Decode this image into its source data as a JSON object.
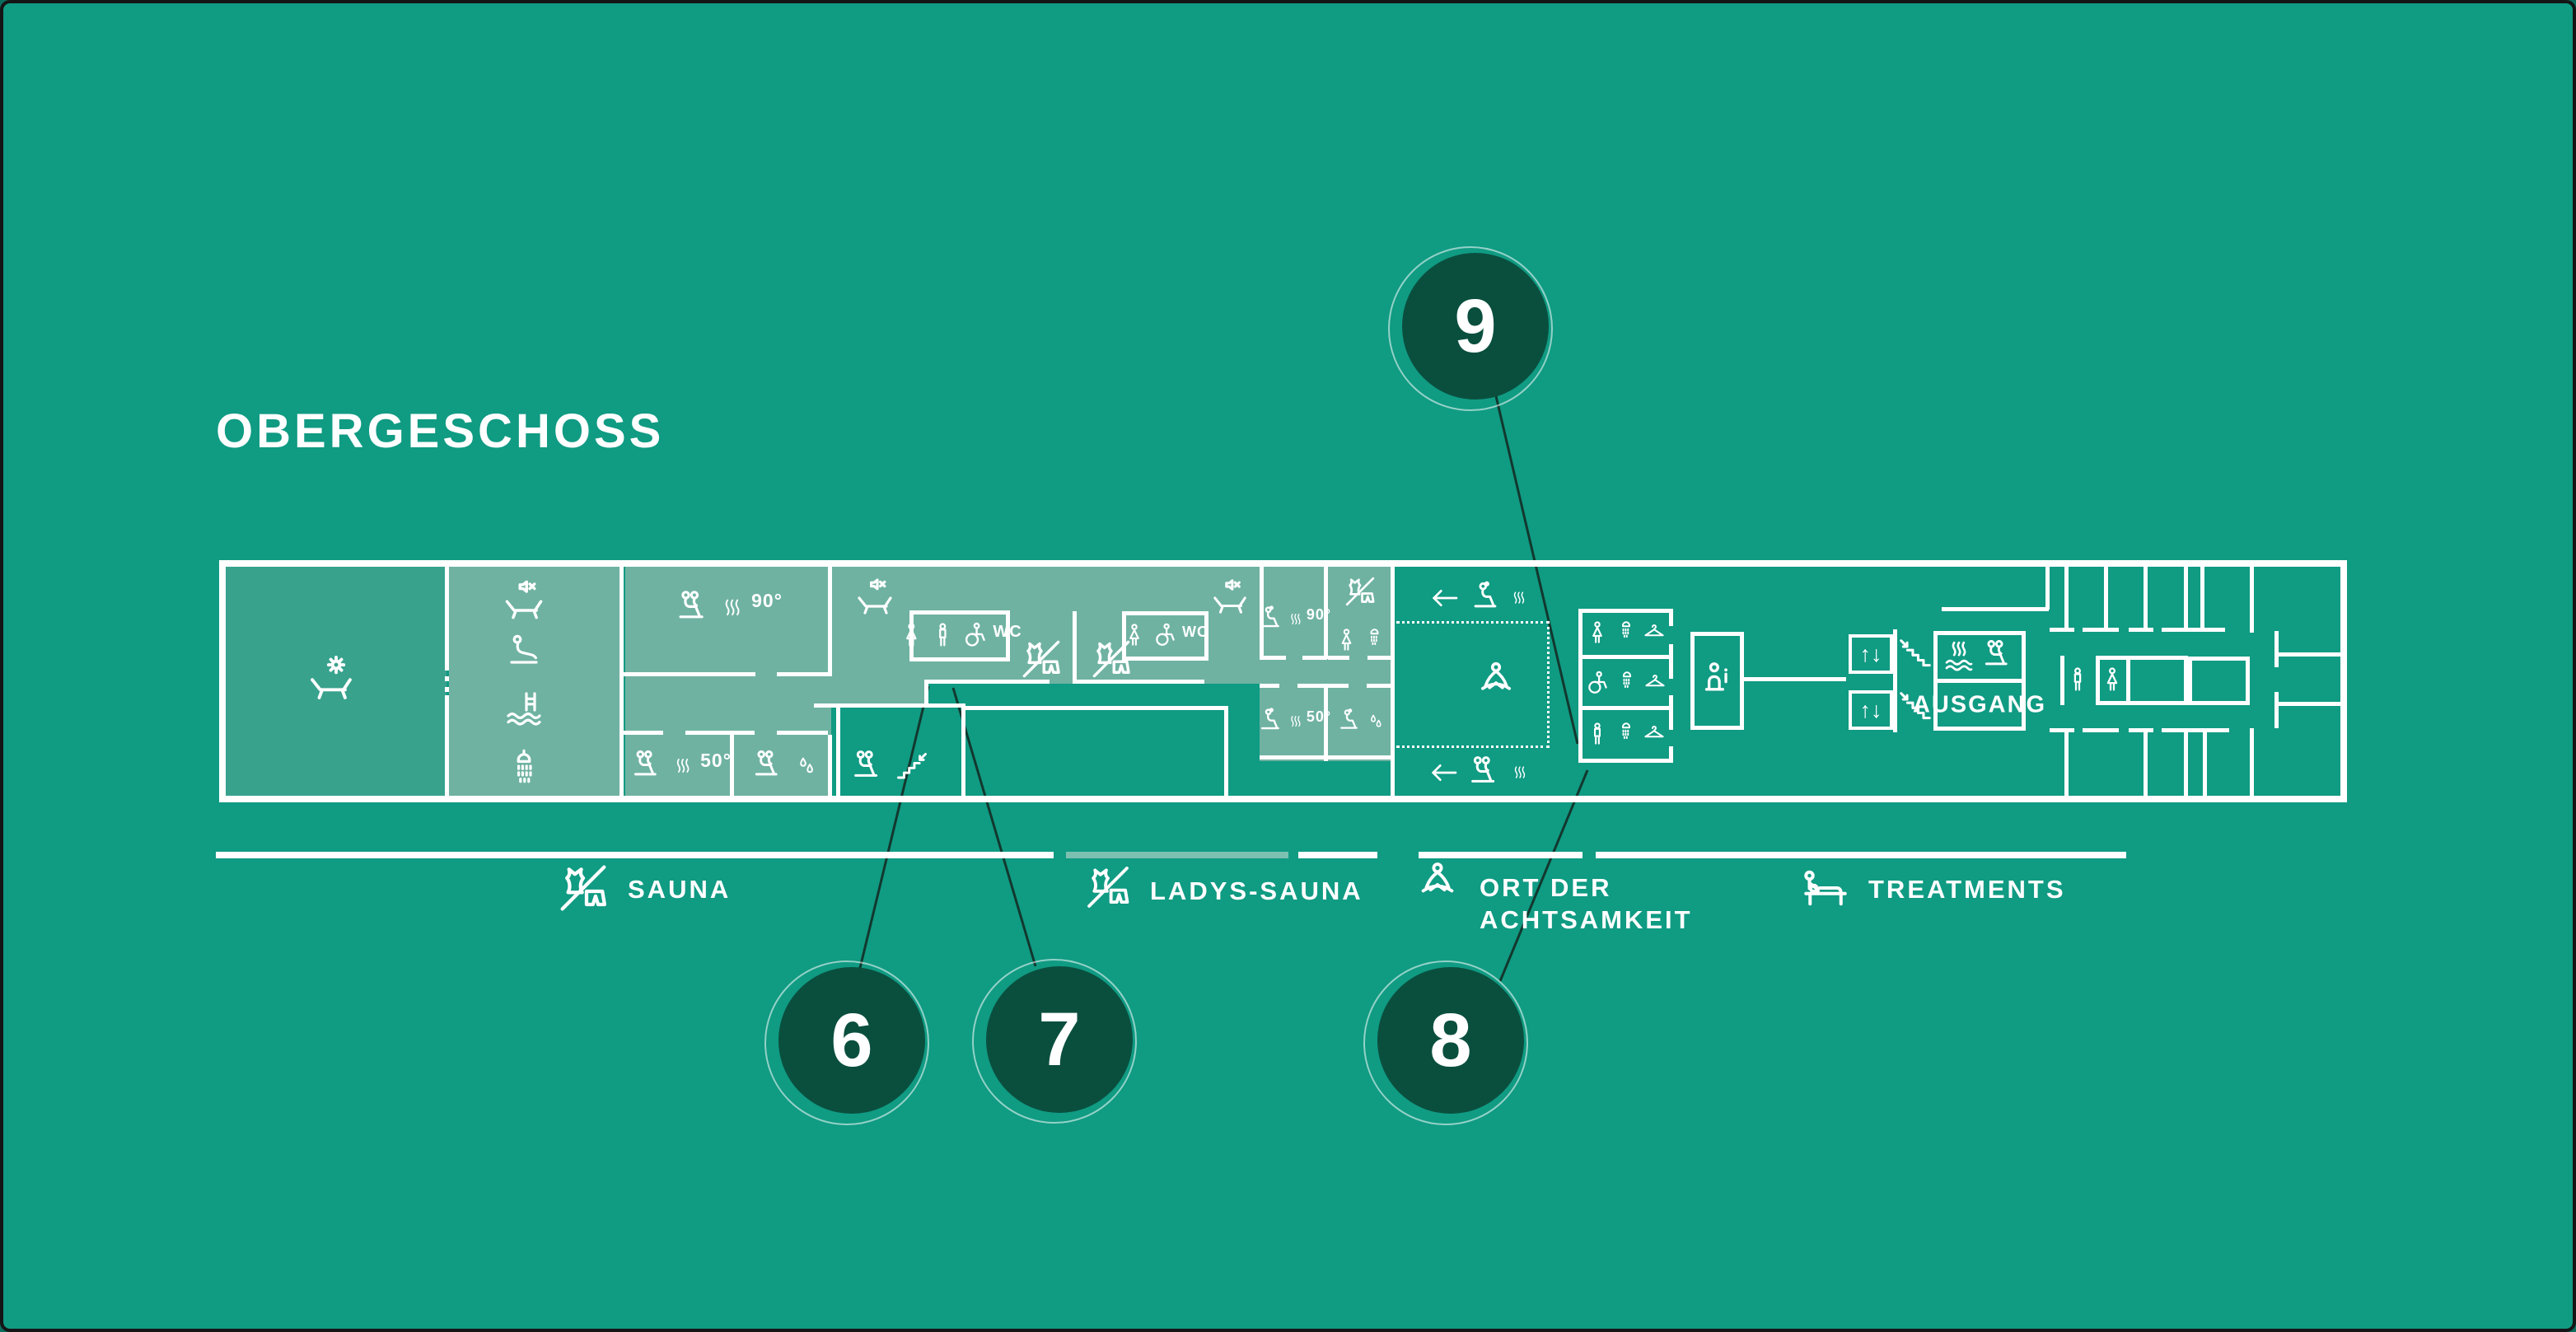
{
  "title": "OBERGESCHOSS",
  "legend": {
    "items": [
      {
        "icon": "no-swimwear-icon",
        "label": "SAUNA",
        "label2": ""
      },
      {
        "icon": "no-swimwear-icon",
        "label": "LADYS-SAUNA",
        "label2": ""
      },
      {
        "icon": "meditation-icon",
        "label": "ORT DER",
        "label2": "ACHTSAMKEIT"
      },
      {
        "icon": "massage-icon",
        "label": "TREATMENTS",
        "label2": ""
      }
    ]
  },
  "markers": [
    {
      "number": "6"
    },
    {
      "number": "7"
    },
    {
      "number": "8"
    },
    {
      "number": "9"
    }
  ],
  "map": {
    "texts": {
      "temp90": "90°",
      "temp50": "50°",
      "wc": "WC",
      "ausgang": "AUSGANG",
      "info": "i",
      "elevator_arrows": "↑↓"
    },
    "icons": [
      "sun-lounger-icon",
      "lounger-mute-icon",
      "person-seated-icon",
      "pool-ladder-icon",
      "shower-icon",
      "sauna-group-icon",
      "sauna-woman-icon",
      "steam-icon",
      "water-drops-icon",
      "no-swimwear-icon",
      "wc-woman-icon",
      "wc-man-icon",
      "wheelchair-icon",
      "arrow-left-icon",
      "meditation-icon",
      "hanger-icon",
      "stairs-down-icon",
      "info-desk-icon",
      "elevator-icon",
      "steam-water-icon",
      "massage-icon",
      "shower-head-icon"
    ]
  },
  "colors": {
    "background": "#109B83",
    "room_light": "#6FB2A2",
    "room_terrace": "#38A28D",
    "marker_circle": "#0A4F3E",
    "wall": "#FFFFFF",
    "connector_line": "#12382E",
    "legend_line_light": "#7CC0B1"
  }
}
